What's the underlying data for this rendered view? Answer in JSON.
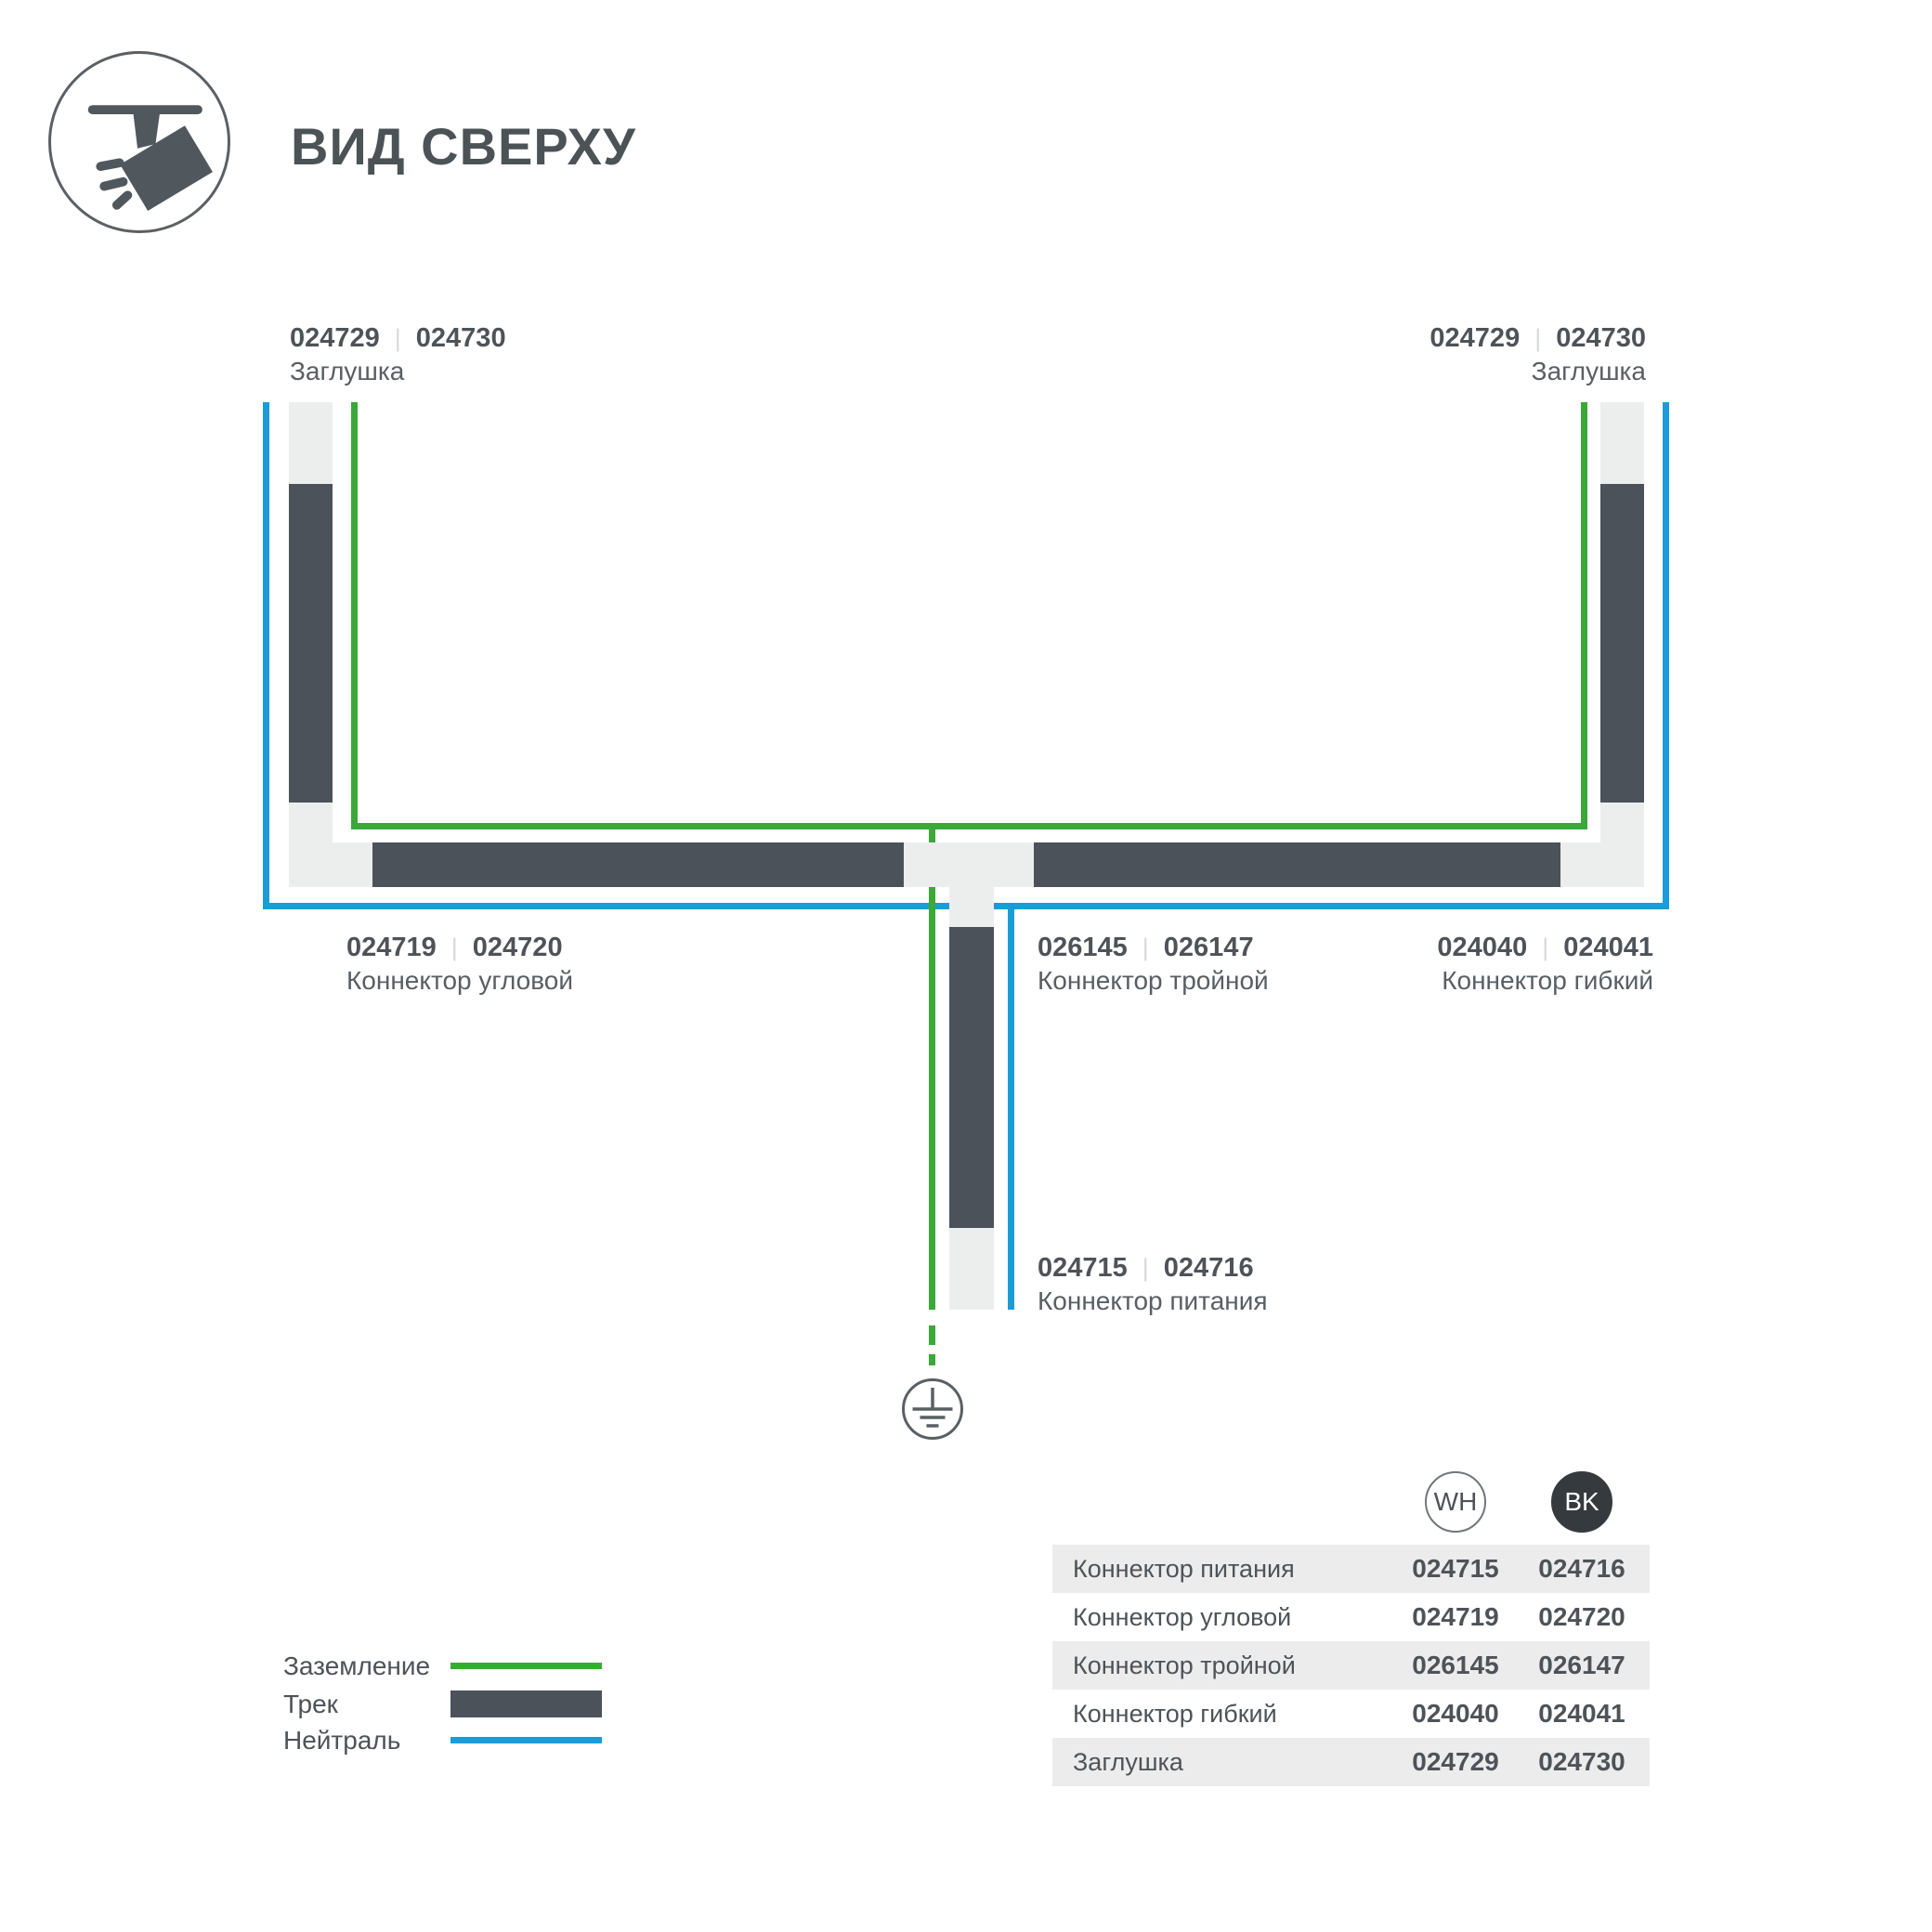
{
  "header": {
    "title": "ВИД СВЕРХУ"
  },
  "ui": {
    "divider": "|"
  },
  "colors": {
    "ground_green": "#3aa938",
    "neutral_blue": "#1a9cd9",
    "track_dark": "#4b525a",
    "connector_light": "#eceeee",
    "table_row_shade": "#ececec",
    "bk_badge": "#343a3e"
  },
  "diagram": {
    "labels": {
      "cap_left": {
        "wh": "024729",
        "bk": "024730",
        "name": "Заглушка"
      },
      "cap_right": {
        "wh": "024729",
        "bk": "024730",
        "name": "Заглушка"
      },
      "corner": {
        "wh": "024719",
        "bk": "024720",
        "name": "Коннектор угловой"
      },
      "triple": {
        "wh": "026145",
        "bk": "026147",
        "name": "Коннектор тройной"
      },
      "flexible": {
        "wh": "024040",
        "bk": "024041",
        "name": "Коннектор гибкий"
      },
      "power": {
        "wh": "024715",
        "bk": "024716",
        "name": "Коннектор питания"
      }
    }
  },
  "legend": {
    "items": [
      {
        "label": "Заземление",
        "type": "ground"
      },
      {
        "label": "Трек",
        "type": "track"
      },
      {
        "label": "Нейтраль",
        "type": "neutral"
      }
    ]
  },
  "table": {
    "columns": {
      "wh": "WH",
      "bk": "BK"
    },
    "rows": [
      {
        "name": "Коннектор питания",
        "wh": "024715",
        "bk": "024716"
      },
      {
        "name": "Коннектор угловой",
        "wh": "024719",
        "bk": "024720"
      },
      {
        "name": "Коннектор тройной",
        "wh": "026145",
        "bk": "026147"
      },
      {
        "name": "Коннектор гибкий",
        "wh": "024040",
        "bk": "024041"
      },
      {
        "name": "Заглушка",
        "wh": "024729",
        "bk": "024730"
      }
    ]
  }
}
